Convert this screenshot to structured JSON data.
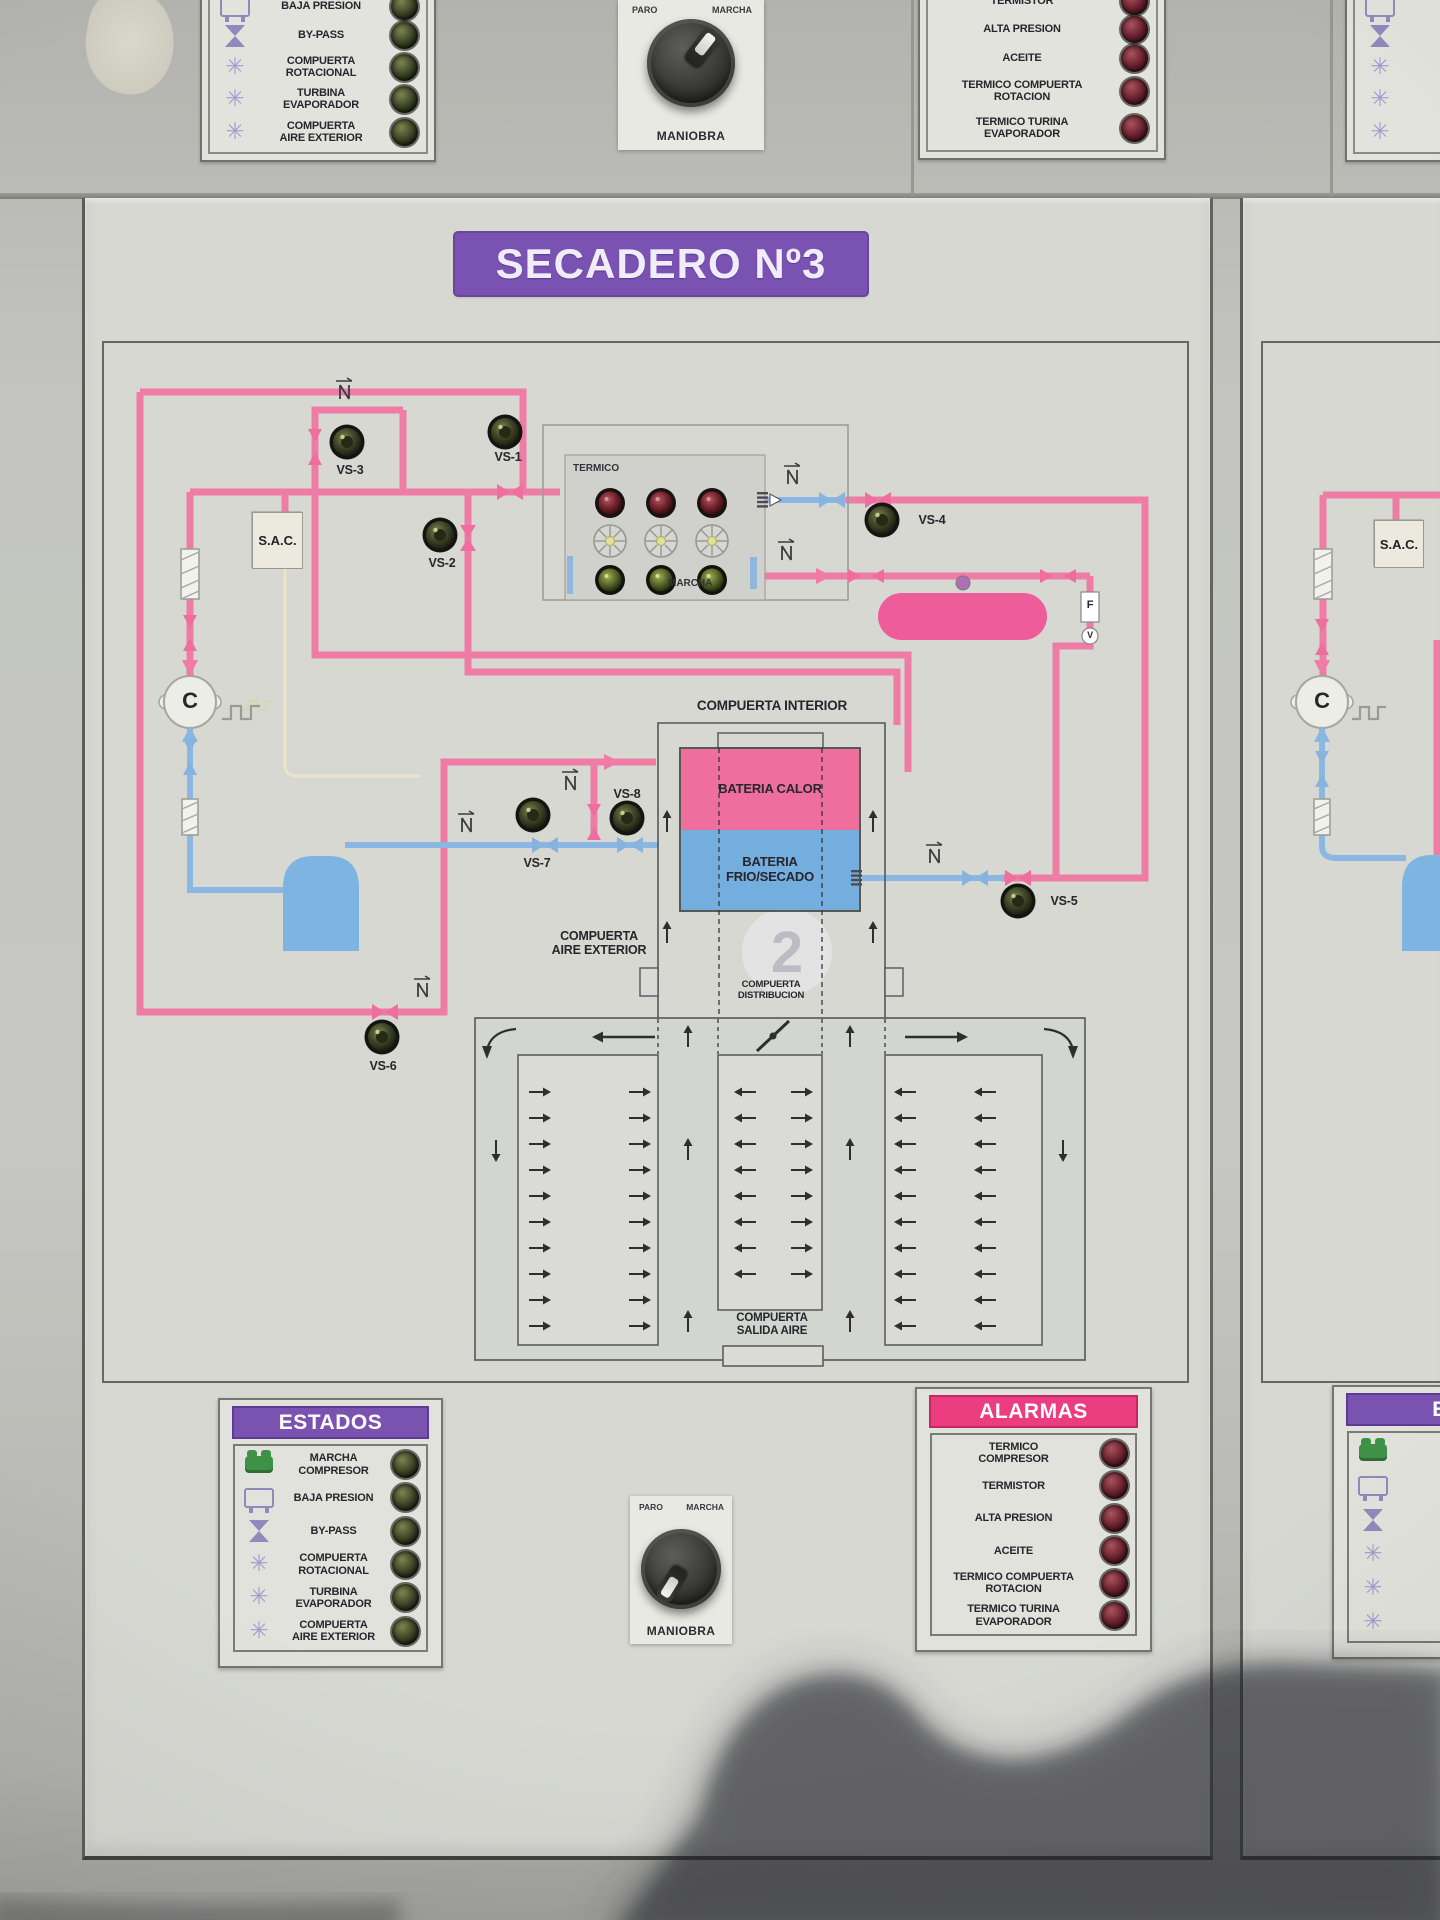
{
  "icons": {
    "fan": "✳"
  },
  "colors": {
    "banner_purple": "#7a53b2",
    "header_pink": "#ec3d80",
    "pipe_hot": "#ee7ca5",
    "pipe_cold": "#8ab8e2",
    "bateria_calor_fill": "#ee6f9e",
    "bateria_frio_fill": "#74aede",
    "tank_hot": "#ee5d99",
    "tank_cold": "#7db4e1"
  },
  "top_row": {
    "left_estados": {
      "rows": [
        {
          "icon": "tank-icon",
          "label": "BAJA PRESION"
        },
        {
          "icon": "valve-icon",
          "label": "BY-PASS"
        },
        {
          "icon": "fan-icon",
          "label": "COMPUERTA\nROTACIONAL"
        },
        {
          "icon": "fan-icon",
          "label": "TURBINA\nEVAPORADOR"
        },
        {
          "icon": "fan-icon",
          "label": "COMPUERTA\nAIRE EXTERIOR"
        }
      ]
    },
    "maniobra": {
      "left": "PARO",
      "right": "MARCHA",
      "caption": "MANIOBRA"
    },
    "right_alarmas": {
      "rows": [
        {
          "label": "TERMISTOR"
        },
        {
          "label": "ALTA PRESION"
        },
        {
          "label": "ACEITE"
        },
        {
          "label": "TERMICO COMPUERTA\nROTACION"
        },
        {
          "label": "TERMICO TURINA\nEVAPORADOR"
        }
      ]
    },
    "far_right_estados": {
      "rows": [
        {
          "icon": "tank-icon",
          "label": "BAJA PRESION"
        },
        {
          "icon": "valve-icon",
          "label": "BY-PASS"
        },
        {
          "icon": "fan-icon",
          "label": "COMPUERTA\nROTACIONAL"
        },
        {
          "icon": "fan-icon",
          "label": "TURBINA\nEVAPORADOR"
        },
        {
          "icon": "fan-icon",
          "label": "COMPUERTA\nAIRE EXTERIOR"
        }
      ]
    }
  },
  "board": {
    "title": "SECADERO Nº3",
    "diagram": {
      "sac": "S.A.C.",
      "compressor": "C",
      "termico": "TERMICO",
      "termico_marcha": "MARCHA",
      "vs": {
        "vs1": "VS-1",
        "vs2": "VS-2",
        "vs3": "VS-3",
        "vs4": "VS-4",
        "vs5": "VS-5",
        "vs6": "VS-6",
        "vs7": "VS-7",
        "vs8": "VS-8"
      },
      "compuerta_interior": "COMPUERTA INTERIOR",
      "bateria_calor": "BATERIA CALOR",
      "bateria_frio": "BATERIA\nFRIO/SECADO",
      "compuerta_aire_exterior": "COMPUERTA\nAIRE EXTERIOR",
      "compuerta_distribucion": "COMPUERTA\nDISTRIBUCION",
      "compuerta_salida": "COMPUERTA\nSALIDA AIRE",
      "f_label": "F",
      "v_label": "V",
      "watermark": "2"
    },
    "estados": {
      "title": "ESTADOS",
      "rows": [
        {
          "icon": "compressor-icon",
          "label": "MARCHA\nCOMPRESOR"
        },
        {
          "icon": "tank-icon",
          "label": "BAJA PRESION"
        },
        {
          "icon": "valve-icon",
          "label": "BY-PASS"
        },
        {
          "icon": "fan-icon",
          "label": "COMPUERTA\nROTACIONAL"
        },
        {
          "icon": "fan-icon",
          "label": "TURBINA\nEVAPORADOR"
        },
        {
          "icon": "fan-icon",
          "label": "COMPUERTA\nAIRE EXTERIOR"
        }
      ]
    },
    "alarmas": {
      "title": "ALARMAS",
      "rows": [
        {
          "label": "TERMICO\nCOMPRESOR"
        },
        {
          "label": "TERMISTOR"
        },
        {
          "label": "ALTA PRESION"
        },
        {
          "label": "ACEITE"
        },
        {
          "label": "TERMICO COMPUERTA\nROTACION"
        },
        {
          "label": "TERMICO TURINA\nEVAPORADOR"
        }
      ]
    },
    "maniobra": {
      "left": "PARO",
      "right": "MARCHA",
      "caption": "MANIOBRA"
    }
  },
  "right_board": {
    "sac": "S.A.C.",
    "compressor": "C",
    "estados": {
      "title": "ESTADOS",
      "rows": [
        {
          "icon": "compressor-icon",
          "label": "MARCHA\nCOMPRESOR"
        },
        {
          "icon": "tank-icon",
          "label": "BAJA PRESION"
        },
        {
          "icon": "valve-icon",
          "label": "BY-PASS"
        },
        {
          "icon": "fan-icon",
          "label": "COMPUERTA\nROTACIONAL"
        },
        {
          "icon": "fan-icon",
          "label": "TURBINA\nEVAPORADOR"
        },
        {
          "icon": "fan-icon",
          "label": "COMPUERTA\nAIRE EXTERIOR"
        }
      ]
    }
  }
}
